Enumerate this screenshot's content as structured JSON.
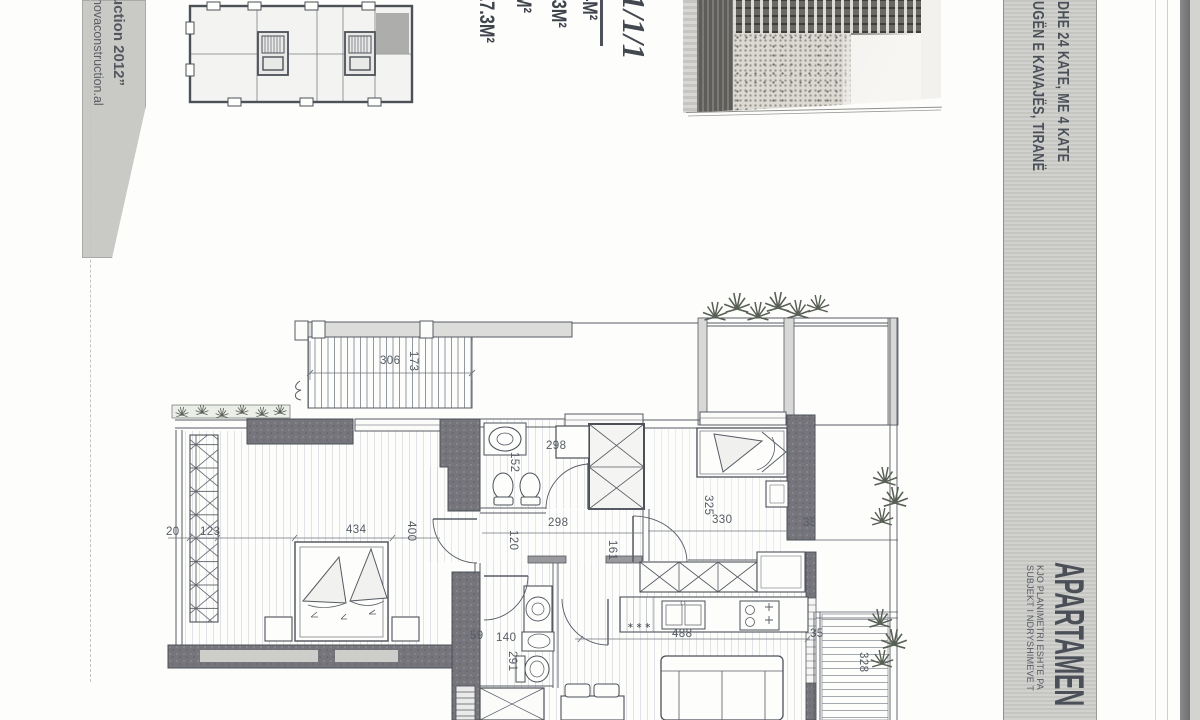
{
  "document": {
    "kind": "scanned apartment floor plan page"
  },
  "stamp_left": {
    "line1": "uction 2012”",
    "line2": "novaconstruction.al"
  },
  "title_band": {
    "header_line1": "DHE 24 KATE, ME 4 KATE",
    "header_line2": "UGËN E KAVAJËS, TIRANË",
    "title": "APARTAMEN",
    "note1": "KJO PLANIMETRI ESHTE PA",
    "note2": "SUBJEKT I NDRYSHIMEVE T"
  },
  "areas": {
    "mark": "1/1/1",
    "row1": "4M²",
    "row2": "0.3M²",
    "row3": "M²",
    "row4": "17.3M²"
  },
  "plan": {
    "dims": {
      "d306": "306",
      "d173": "173",
      "d20": "20",
      "d123": "123",
      "d434": "434",
      "d400": "400",
      "d298a": "298",
      "d152": "152",
      "d298b": "298",
      "d120": "120",
      "d161": "161",
      "d325": "325",
      "d330": "330",
      "d35a": "35",
      "d488": "488",
      "d35b": "35",
      "d140": "140",
      "d291": "291",
      "d59": "59",
      "d328": "328"
    },
    "marks": {
      "kitchen": "∗∗∗"
    }
  },
  "colors": {
    "band_gray": "#cbcbc8",
    "wall_dark": "#75757b",
    "line": "#4c5158"
  }
}
